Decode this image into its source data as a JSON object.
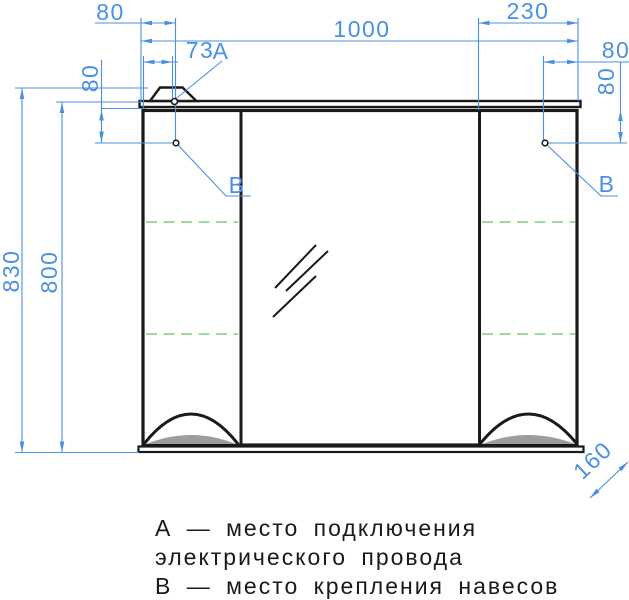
{
  "drawing": {
    "kind": "mirror-cabinet-technical-drawing",
    "units": "mm",
    "dims": {
      "overall_width": "1000",
      "overall_height": "830",
      "carcass_height": "800",
      "right_cabinet_width": "230",
      "depth": "160",
      "point_a_offset_outer": "80",
      "point_a_offset_inner": "73",
      "point_b_left_drop": "80",
      "point_b_right_inset": "80",
      "point_b_right_drop": "80"
    },
    "points": {
      "a": "A",
      "b_left": "B",
      "b_right": "B"
    }
  },
  "legend": {
    "line1": "А — место подключения",
    "line2": "электрического провода",
    "line3": "В — место крепления навесов"
  },
  "colors": {
    "line_black": "#1a1a1a",
    "dimension_blue": "#4a90e2",
    "shelf_green": "#94d594",
    "handle_gray": "#9d9d9d",
    "background": "#ffffff"
  }
}
